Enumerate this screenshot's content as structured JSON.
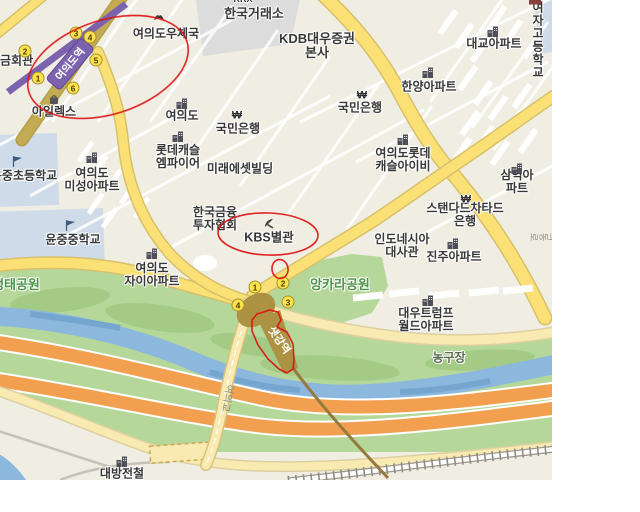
{
  "palette": {
    "bg_beige": "#f0ede3",
    "road_yellow": "#fbe175",
    "road_casing": "#d8c06a",
    "road_khaki": "#c2ab52",
    "road_pale": "#f8eab0",
    "subway_purple": "#7c63ae",
    "park_green": "#b5d79a",
    "park_green_dark": "#a3cb85",
    "stream_blue": "#8cb8dd",
    "stream_dark": "#75a6d0",
    "highway_orange": "#f2a050",
    "annotation_red": "#dd1111",
    "exit_yellow": "#ffe14d",
    "exit_border": "#a3922a",
    "station_brown": "#ad9243",
    "rail_line_brown": "#96793c",
    "green_text": "#4c9348",
    "school_block_blue": "#cfdbe9",
    "exchange_block_gray": "#dcdcdc"
  },
  "labels": [
    {
      "n": "krx-label-partial",
      "t": "KRX",
      "x": 243,
      "y": 0,
      "s": 9
    },
    {
      "n": "korea-exchange-label",
      "t": "한국거래소",
      "x": 254,
      "y": 14,
      "s": 13
    },
    {
      "n": "kdb-daewoo-hq-label",
      "t": "KDB대우증권\n본사",
      "x": 317,
      "y": 46,
      "s": 13
    },
    {
      "n": "post-office-label",
      "t": "여의도우체국",
      "x": 166,
      "y": 34
    },
    {
      "n": "girls-high-school-label",
      "t": "여의도여자\n고등학교",
      "x": 538,
      "y": 21
    },
    {
      "n": "daekyo-apt-label",
      "t": "대교아파트",
      "x": 494,
      "y": 44
    },
    {
      "n": "hanyang-apt-label",
      "t": "한양아파트",
      "x": 429,
      "y": 87
    },
    {
      "n": "kookmin-bank-east-label",
      "t": "국민은행",
      "x": 360,
      "y": 108
    },
    {
      "n": "kookmin-bank-west-label",
      "t": "국민은행",
      "x": 238,
      "y": 129
    },
    {
      "n": "yeouido-building-label",
      "t": "여의도",
      "x": 182,
      "y": 116
    },
    {
      "n": "ilex-label",
      "t": "아일렉스",
      "x": 54,
      "y": 112
    },
    {
      "n": "pension-hall-label",
      "t": "사학연금회관",
      "x": 0,
      "y": 61
    },
    {
      "n": "lotte-castle-empire-label",
      "t": "롯데캐슬\n엠파이어",
      "x": 178,
      "y": 157
    },
    {
      "n": "mirae-asset-label",
      "t": "미래에셋빌딩",
      "x": 240,
      "y": 169
    },
    {
      "n": "misung-apt-label",
      "t": "여의도\n미성아파트",
      "x": 92,
      "y": 180
    },
    {
      "n": "yunjung-elementary-label",
      "t": "윤중초등학교",
      "x": 24,
      "y": 176
    },
    {
      "n": "kofia-label",
      "t": "한국금융\n투자협회",
      "x": 215,
      "y": 219
    },
    {
      "n": "kbs-annex-label",
      "t": "KBS별관",
      "x": 269,
      "y": 238,
      "s": 12.5
    },
    {
      "n": "lotte-castle-ivy-label",
      "t": "여의도롯데\n캐슬아이비",
      "x": 403,
      "y": 160
    },
    {
      "n": "samik-apt-label",
      "t": "삼익아파트",
      "x": 517,
      "y": 182
    },
    {
      "n": "standard-chartered-label",
      "t": "스탠다드차타드은행",
      "x": 465,
      "y": 215
    },
    {
      "n": "indonesia-embassy-label",
      "t": "인도네시아\n대사관",
      "x": 402,
      "y": 246
    },
    {
      "n": "jinju-apt-label",
      "t": "진주아파트",
      "x": 454,
      "y": 257
    },
    {
      "n": "yeouido-xi-apt-label",
      "t": "여의도\n자이아파트",
      "x": 152,
      "y": 275
    },
    {
      "n": "yunjung-middle-school-label",
      "t": "윤중중학교",
      "x": 73,
      "y": 240
    },
    {
      "n": "saetgang-eco-park-label",
      "t": "샛강생태공원",
      "x": 4,
      "y": 285,
      "s": 13,
      "c": "green"
    },
    {
      "n": "ankara-park-label",
      "t": "앙카라공원",
      "x": 340,
      "y": 285,
      "s": 13,
      "c": "green"
    },
    {
      "n": "trump-world-apt-label",
      "t": "대우트럼프\n월드아파트",
      "x": 426,
      "y": 320
    },
    {
      "n": "basketball-court-label",
      "t": "농구장",
      "x": 449,
      "y": 358,
      "c": "greenGray"
    },
    {
      "n": "daebang-rail-label",
      "t": "대방전철",
      "x": 122,
      "y": 474
    },
    {
      "n": "yeouigyo-bridge-label",
      "t": "여의교",
      "x": 226,
      "y": 398,
      "s": 10,
      "r": 100,
      "c": "gray"
    },
    {
      "n": "saetgang-station-label",
      "t": "샛강역",
      "x": 278,
      "y": 341,
      "s": 11,
      "r": 55,
      "c": "white"
    },
    {
      "n": "yeouidong-ro-label",
      "t": "여의동로",
      "x": 547,
      "y": 237,
      "s": 9,
      "r": 90,
      "c": "gray"
    }
  ],
  "icons": [
    {
      "t": "post",
      "x": 159,
      "y": 17
    },
    {
      "t": "apartment",
      "x": 493,
      "y": 31
    },
    {
      "t": "apartment",
      "x": 428,
      "y": 72
    },
    {
      "t": "won",
      "x": 362,
      "y": 96
    },
    {
      "t": "won",
      "x": 237,
      "y": 116
    },
    {
      "t": "apartment",
      "x": 182,
      "y": 103
    },
    {
      "t": "bag",
      "x": 54,
      "y": 99
    },
    {
      "t": "apartment",
      "x": 178,
      "y": 136
    },
    {
      "t": "apartment",
      "x": 92,
      "y": 157
    },
    {
      "t": "flag",
      "x": 17,
      "y": 161
    },
    {
      "t": "flag",
      "x": 70,
      "y": 225
    },
    {
      "t": "antenna",
      "x": 269,
      "y": 223
    },
    {
      "t": "apartment",
      "x": 403,
      "y": 139
    },
    {
      "t": "apartment",
      "x": 517,
      "y": 168
    },
    {
      "t": "won",
      "x": 466,
      "y": 200
    },
    {
      "t": "apartment",
      "x": 453,
      "y": 243
    },
    {
      "t": "apartment",
      "x": 152,
      "y": 253
    },
    {
      "t": "apartment",
      "x": 428,
      "y": 300
    },
    {
      "t": "apartment",
      "x": 122,
      "y": 461
    },
    {
      "t": "school",
      "x": 535,
      "y": 2
    }
  ],
  "subway": {
    "yeouido": {
      "badge": "여의도역",
      "exits": [
        {
          "n": "1",
          "x": 38,
          "y": 78
        },
        {
          "n": "2",
          "x": 25,
          "y": 51
        },
        {
          "n": "3",
          "x": 76,
          "y": 33
        },
        {
          "n": "4",
          "x": 90,
          "y": 37
        },
        {
          "n": "5",
          "x": 96,
          "y": 60
        },
        {
          "n": "6",
          "x": 73,
          "y": 88
        }
      ]
    },
    "saetgang": {
      "exits": [
        {
          "n": "1",
          "x": 255,
          "y": 287
        },
        {
          "n": "2",
          "x": 283,
          "y": 283
        },
        {
          "n": "3",
          "x": 288,
          "y": 302
        },
        {
          "n": "4",
          "x": 238,
          "y": 305
        }
      ]
    }
  },
  "annotations": {
    "color": "#dd1111",
    "items": [
      "yeouido-station-circle",
      "kbs-annex-circle",
      "small-circle",
      "saetgang-station-outline"
    ]
  }
}
